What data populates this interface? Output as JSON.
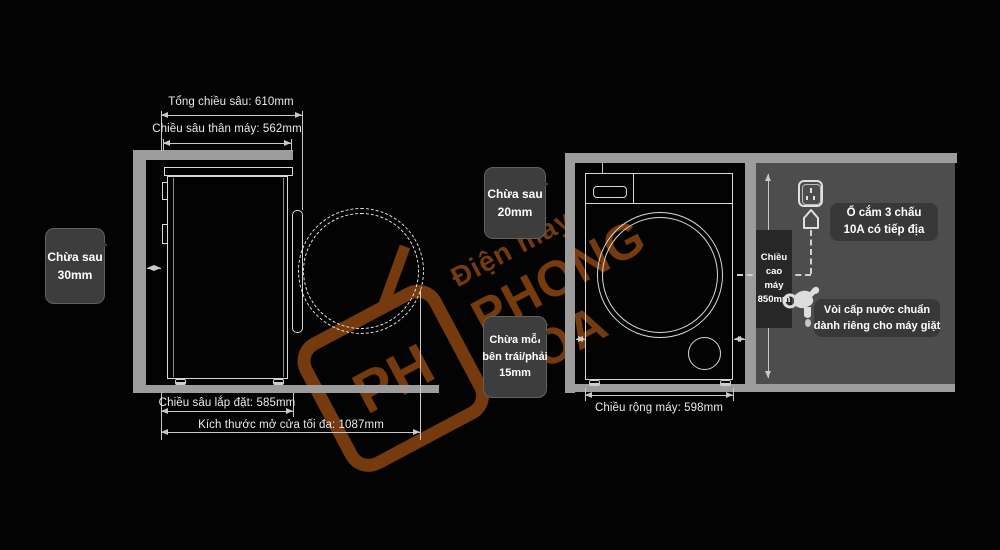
{
  "diagram_title": "Washing machine installation clearance diagram",
  "watermark": {
    "brand_small": "Điện máy",
    "brand_large": "PHONG HÒA",
    "logo_text": "PH"
  },
  "side_view": {
    "dim_total_depth": "Tổng chiều sâu: 610mm",
    "dim_body_depth": "Chiều sâu thân máy: 562mm",
    "dim_install_depth": "Chiều sâu lắp đặt: 585mm",
    "dim_door_open": "Kích thước mở cửa tối đa: 1087mm",
    "callout_rear": {
      "line1": "Chừa sau",
      "line2": "30mm"
    }
  },
  "front_view": {
    "dim_width": "Chiều rộng máy: 598mm",
    "callout_top": {
      "line1": "Chừa sau",
      "line2": "20mm"
    },
    "callout_sides": {
      "line1": "Chừa mỗi",
      "line2": "bên trái/phải",
      "line3": "15mm"
    },
    "height_badge": {
      "line1": "Chiều",
      "line2": "cao",
      "line3": "máy",
      "line4": "850mm"
    },
    "label_socket": {
      "line1": "Ổ cắm 3 chấu",
      "line2": "10A có tiếp địa"
    },
    "label_faucet": {
      "line1": "Vòi cấp nước chuẩn",
      "line2": "dành riêng cho máy giặt"
    }
  },
  "colors": {
    "background": "#030303",
    "wall_gray": "#9c9c9c",
    "panel_gray": "#4d4d4d",
    "bubble_gray": "#3d3d3d",
    "label_gray": "#383838",
    "badge_gray": "#272727",
    "line_light": "#d8d8d8",
    "watermark_orange": "#7c3d0e"
  }
}
